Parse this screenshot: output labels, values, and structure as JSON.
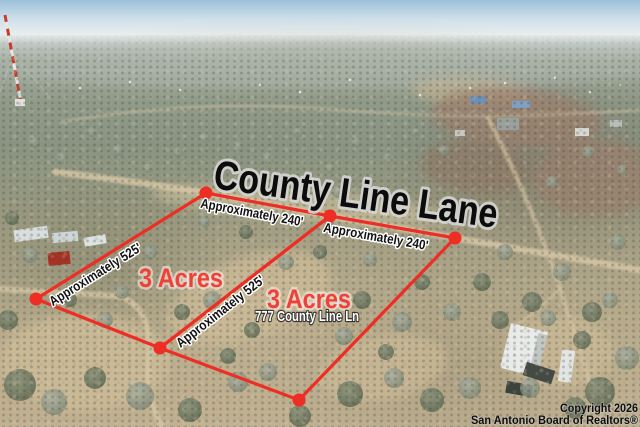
{
  "title": {
    "text": "County Line Lane"
  },
  "parcels": [
    {
      "acres": "3 Acres"
    },
    {
      "acres": "3 Acres",
      "address": "777 County Line Ln"
    }
  ],
  "measurements": [
    {
      "label": "Approximately 240'"
    },
    {
      "label": "Approximately 240'"
    },
    {
      "label": "Approximately 525'"
    },
    {
      "label": "Approximately 525'"
    }
  ],
  "watermark": {
    "line1": "Copyright 2026",
    "line2": "San Antonio Board of Realtors®"
  },
  "colors": {
    "boundary_red": "#ee2d24",
    "acres_red": "#ef4137",
    "title_black": "#0c0c0c"
  }
}
